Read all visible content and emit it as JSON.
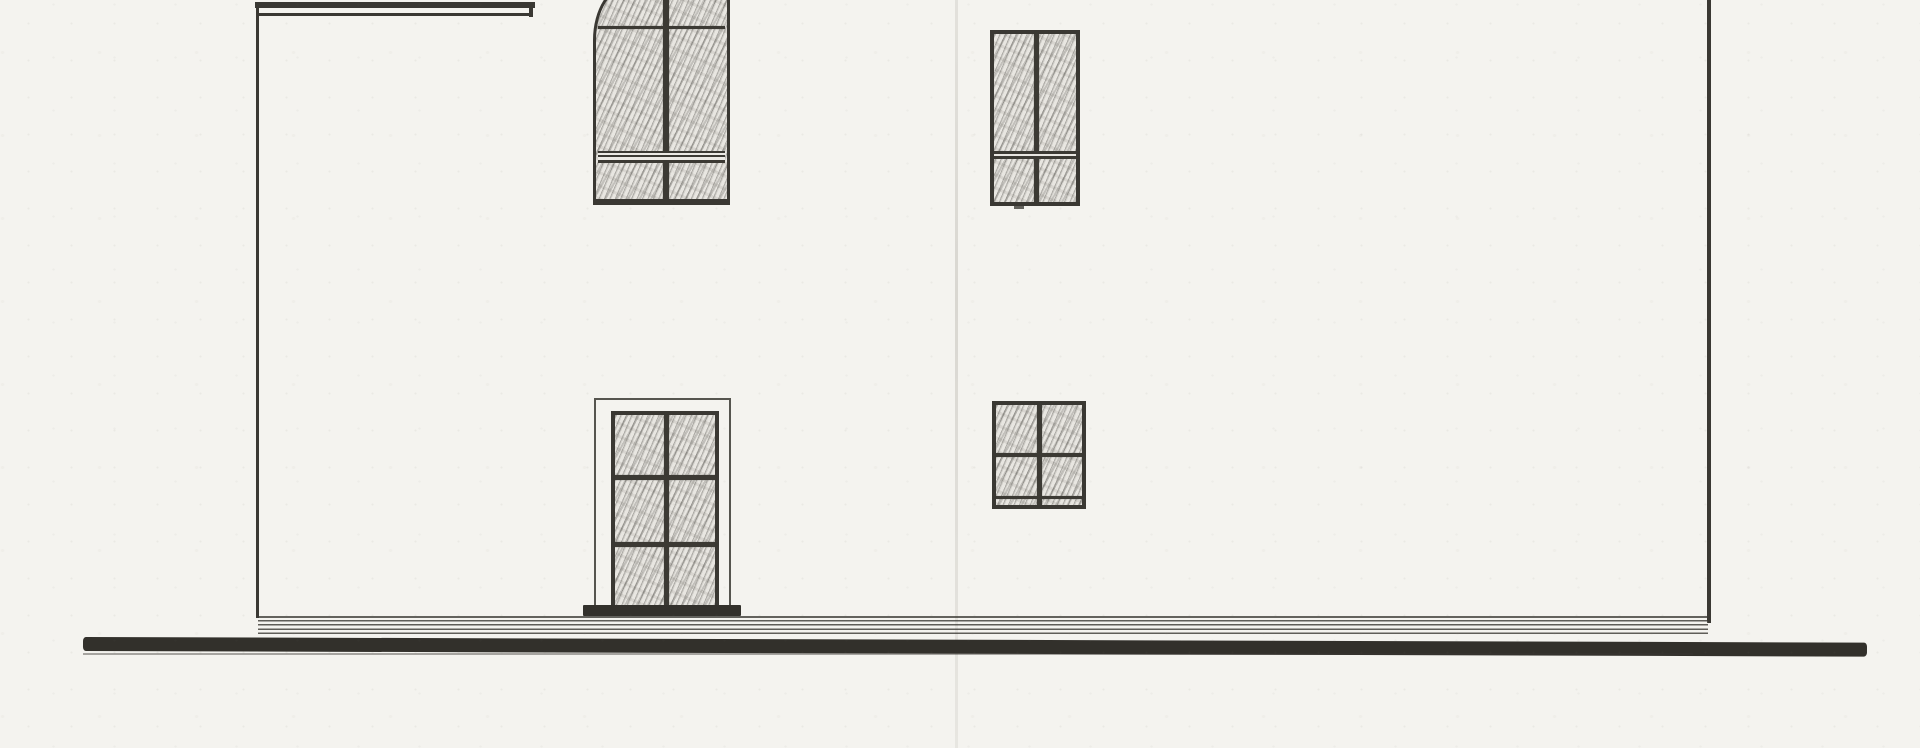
{
  "meta": {
    "domain": "scanned architectural drawing",
    "title": "House side elevation - pencil drawing scan",
    "description": "Scanned hand-drawn side elevation of a two-storey house: a roof eave at the upper left, an arched-top upper window, a second upper window, a tall six-pane door-window and a small four-pane window below, slender wall edge lines left and right, stacked plinth course lines at the base and a heavy dark ground line running almost the full sheet width; a faint vertical paper fold crease crosses the middle; no text, dimensions or labels are visible on the sheet.",
    "visible_text": []
  },
  "palette": {
    "paper": "#f4f3ef",
    "ink": "#3a3833",
    "ink_heavy": "#32302b",
    "hatch_base": "#e8e6e1",
    "crease": "#78726a"
  },
  "drawing": {
    "structure": [
      {
        "name": "paper-fold-crease",
        "cls": "crease",
        "x": 955,
        "y": 0,
        "w": 3,
        "h": 748
      },
      {
        "name": "roof-eave-thick-line",
        "cls": "line",
        "x": 255,
        "y": 2,
        "w": 280,
        "h": 6
      },
      {
        "name": "roof-eave-thin-line",
        "cls": "line",
        "x": 257,
        "y": 13,
        "w": 276,
        "h": 3
      },
      {
        "name": "roof-eave-end-cap",
        "cls": "line",
        "x": 529,
        "y": 2,
        "w": 4,
        "h": 15
      },
      {
        "name": "left-wall-edge-line",
        "cls": "line",
        "x": 256,
        "y": 5,
        "w": 3,
        "h": 613
      },
      {
        "name": "right-wall-edge-line",
        "cls": "line",
        "x": 1707,
        "y": 0,
        "w": 4,
        "h": 623
      },
      {
        "name": "facade-base-line",
        "cls": "line-soft",
        "x": 257,
        "y": 616,
        "w": 1452,
        "h": 2
      },
      {
        "name": "plinth-course-lines",
        "cls": "plinth",
        "x": 258,
        "y": 620,
        "w": 1450,
        "h": 17
      },
      {
        "name": "ground-line-band",
        "cls": "ground",
        "x": 83,
        "y": 637,
        "w": 1784,
        "h": 14
      },
      {
        "name": "ground-underline",
        "cls": "line-faint",
        "x": 83,
        "y": 653,
        "w": 1610,
        "h": 2
      },
      {
        "name": "window-sill-tick",
        "cls": "line-soft",
        "x": 1014,
        "y": 206,
        "w": 10,
        "h": 3
      }
    ],
    "windows": [
      {
        "name": "upper-left-arched-window",
        "parts": [
          {
            "name": "upper-left-arched-window-frame",
            "cls": "frame arch hatch",
            "x": 593,
            "y": -16,
            "w": 137,
            "h": 221
          },
          {
            "name": "upper-left-arched-window-top-bar",
            "cls": "bar",
            "x": 598,
            "y": 26,
            "w": 127,
            "h": 3
          },
          {
            "name": "upper-left-arched-window-mullion",
            "cls": "bar",
            "x": 663,
            "y": 0,
            "w": 6,
            "h": 199
          },
          {
            "name": "upper-left-arched-window-rail",
            "cls": "rail3",
            "x": 598,
            "y": 151,
            "w": 127,
            "h": 12
          }
        ]
      },
      {
        "name": "upper-right-window",
        "parts": [
          {
            "name": "upper-right-window-frame",
            "cls": "frame f4 hatch",
            "x": 990,
            "y": 30,
            "w": 90,
            "h": 176
          },
          {
            "name": "upper-right-window-mullion",
            "cls": "bar",
            "x": 1034,
            "y": 34,
            "w": 5,
            "h": 168
          },
          {
            "name": "upper-right-window-rail",
            "cls": "rail2",
            "x": 994,
            "y": 151,
            "w": 82,
            "h": 8
          }
        ]
      },
      {
        "name": "lower-left-door-window",
        "parts": [
          {
            "name": "door-window-outer-trim",
            "cls": "trim",
            "x": 594,
            "y": 398,
            "w": 137,
            "h": 214
          },
          {
            "name": "door-window-frame",
            "cls": "frame f4 hatch",
            "x": 611,
            "y": 411,
            "w": 108,
            "h": 200
          },
          {
            "name": "door-window-mullion",
            "cls": "bar",
            "x": 664,
            "y": 415,
            "w": 5,
            "h": 192
          },
          {
            "name": "door-window-upper-bar",
            "cls": "bar",
            "x": 615,
            "y": 475,
            "w": 100,
            "h": 5
          },
          {
            "name": "door-window-lower-bar",
            "cls": "bar",
            "x": 615,
            "y": 542,
            "w": 100,
            "h": 5
          },
          {
            "name": "door-window-sill",
            "cls": "sill",
            "x": 583,
            "y": 605,
            "w": 158,
            "h": 11
          }
        ]
      },
      {
        "name": "lower-right-small-window",
        "parts": [
          {
            "name": "small-window-frame",
            "cls": "frame f4 hatch",
            "x": 992,
            "y": 401,
            "w": 94,
            "h": 108
          },
          {
            "name": "small-window-mullion",
            "cls": "bar",
            "x": 1037,
            "y": 405,
            "w": 5,
            "h": 100
          },
          {
            "name": "small-window-rail",
            "cls": "bar",
            "x": 996,
            "y": 453,
            "w": 86,
            "h": 4
          },
          {
            "name": "small-window-inner-sill-line",
            "cls": "bar",
            "x": 996,
            "y": 496,
            "w": 86,
            "h": 3
          }
        ]
      }
    ]
  }
}
